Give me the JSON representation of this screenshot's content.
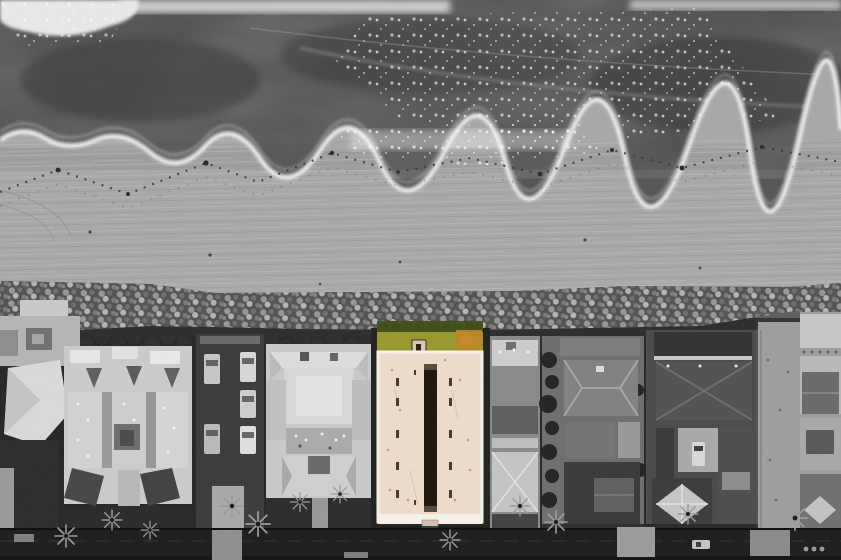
{
  "image": {
    "kind": "aerial drone photograph, top-down",
    "treatment": "selective-color: entire scene black & white except the featured property",
    "caption": "Top-down aerial of an oceanfront block: surf and foam at top, wide raked sand beach with a kelp debris line, a riprap rock revetment, then a row of beachfront homes along a dark street; the featured flat-roofed property with a green lawn is the only element in color.",
    "width_px": 841,
    "height_px": 560
  },
  "scene": {
    "regions": [
      {
        "name": "ocean",
        "description": "dark seawater, whitewash foam along the very top edge and speckled surf patches"
      },
      {
        "name": "surf-line",
        "description": "scalloped white foam edge where waves meet the wet sand"
      },
      {
        "name": "beach",
        "description": "wide groomed sand with fine horizontal rake/vehicle tracks and a zig-zag tide debris line"
      },
      {
        "name": "rock-revetment",
        "description": "continuous band of riprap boulders between beach and homes"
      },
      {
        "name": "homes-row",
        "description": "beachfront lots with varied gray rooftops, a parking alley with cars, trees and hedges"
      },
      {
        "name": "street",
        "description": "dark asphalt strip along the bottom with palm trees and sidewalk patches"
      }
    ],
    "highlighted_property": {
      "position": "center of the housing row, facing the beach",
      "is_only_color_element": true,
      "features": [
        "cream flat roof with white parapet edges",
        "long dark central courtyard/skylight slot",
        "paired dark roof vents along both sides",
        "green front lawn with dark hedge at the sand line",
        "orange-brown turf patch at lawn's right corner",
        "small gate structure at the beach edge",
        "small bump-out at the street edge"
      ]
    },
    "neighboring_lots": [
      "turreted light house at far left",
      "large light gabled house with three dormers and two dark bottom gable roofs",
      "parking alley with five parked cars and a light driveway",
      "symmetrical white multi-roof house with center deck",
      "tall gray narrow house with bottom hip roof",
      "dark lot with tree row, hip roof and garden",
      "dark-roof compound with courtyard, parked car and light pyramid roof",
      "vacant sandy lot",
      "partially visible house at right edge"
    ]
  },
  "colors": {
    "ocean": "#484848",
    "foam": "#f5f5f5",
    "sand": "#a8a8a8",
    "rock_base": "#575757",
    "ground": "#272727",
    "street": "#1e1e1e",
    "building_cream": "#eddccb",
    "parapet_white": "#f7f2e9",
    "slot_dark": "#20160e",
    "lawn_green": "#97992e",
    "hedge_green": "#44511b",
    "lawn_orange": "#bf8426",
    "trim_tan": "#d8c9b2",
    "roof_light": "#cbcbcb",
    "roof_mid": "#8a8a8a",
    "roof_dark": "#4b4b4b"
  }
}
